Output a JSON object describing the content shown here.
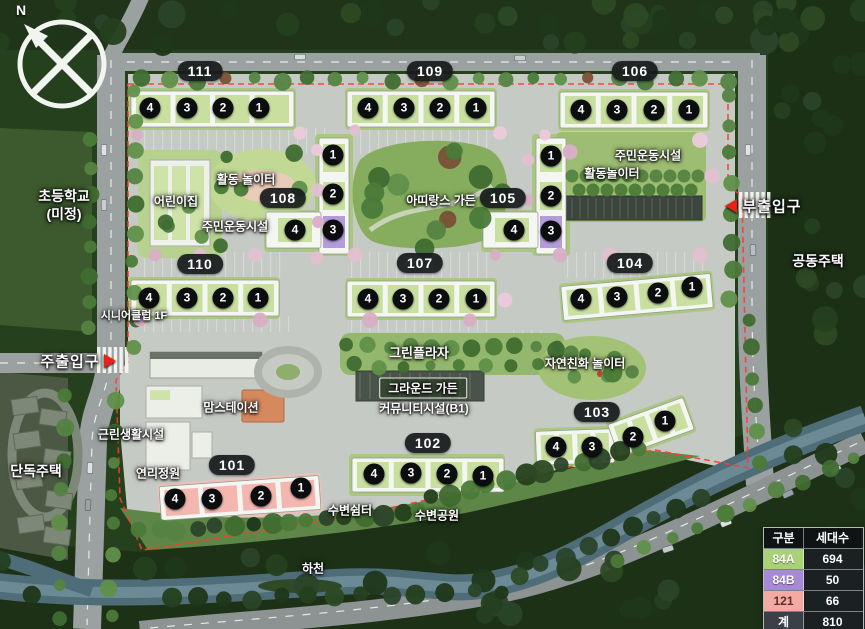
{
  "compass": {
    "north_label": "N"
  },
  "entrances": {
    "main": "주출입구",
    "sub": "부출입구"
  },
  "surroundings": {
    "school_line1": "초등학교",
    "school_line2": "(미정)",
    "apartment_housing": "공동주택",
    "detached_housing": "단독주택",
    "stream": "하천"
  },
  "facilities": {
    "daycare": "어린이집",
    "activity_playground_west": "활동 놀이터",
    "resident_sports_west": "주민운동시설",
    "attirance_garden": "아띠랑스 가든",
    "resident_sports_east": "주민운동시설",
    "activity_playground_east": "활동놀이터",
    "senior_club": "시니어클럽 1F",
    "neighborhood_facility": "근린생활시설",
    "mom_station": "맘스테이션",
    "yeonri_garden": "연리정원",
    "green_plaza": "그린플라자",
    "nature_playground": "자연친화 놀이터",
    "ground_garden": "그라운드 가든",
    "community_facility": "커뮤니티시설(B1)",
    "waterside_rest": "수변쉼터",
    "waterside_park": "수변공원"
  },
  "buildings": {
    "b101": {
      "label": "101",
      "units": [
        "4",
        "3",
        "2",
        "1"
      ],
      "type": "121"
    },
    "b102": {
      "label": "102",
      "units": [
        "4",
        "3",
        "2",
        "1"
      ],
      "type": "84A"
    },
    "b103": {
      "label": "103",
      "units": [
        "4",
        "3",
        "2",
        "1"
      ],
      "type": "84A"
    },
    "b104": {
      "label": "104",
      "units": [
        "4",
        "3",
        "2",
        "1"
      ],
      "type": "84A"
    },
    "b105": {
      "label": "105",
      "units": [
        "1",
        "2",
        "3",
        "4"
      ],
      "type": "84A/84B"
    },
    "b106": {
      "label": "106",
      "units": [
        "4",
        "3",
        "2",
        "1"
      ],
      "type": "84A"
    },
    "b107": {
      "label": "107",
      "units": [
        "4",
        "3",
        "2",
        "1"
      ],
      "type": "84A"
    },
    "b108": {
      "label": "108",
      "units": [
        "1",
        "2",
        "3",
        "4"
      ],
      "type": "84A/84B"
    },
    "b109": {
      "label": "109",
      "units": [
        "4",
        "3",
        "2",
        "1"
      ],
      "type": "84A"
    },
    "b110": {
      "label": "110",
      "units": [
        "4",
        "3",
        "2",
        "1"
      ],
      "type": "84A"
    },
    "b111": {
      "label": "111",
      "units": [
        "4",
        "3",
        "2",
        "1"
      ],
      "type": "84A"
    }
  },
  "legend": {
    "headers": [
      "구분",
      "세대수"
    ],
    "rows": [
      {
        "type": "84A",
        "count": "694",
        "color": "#a9d176"
      },
      {
        "type": "84B",
        "count": "50",
        "color": "#a58bd6"
      },
      {
        "type": "121",
        "count": "66",
        "color": "#f3a9a4"
      },
      {
        "type": "계",
        "count": "810",
        "color": "#3a4046"
      }
    ]
  }
}
